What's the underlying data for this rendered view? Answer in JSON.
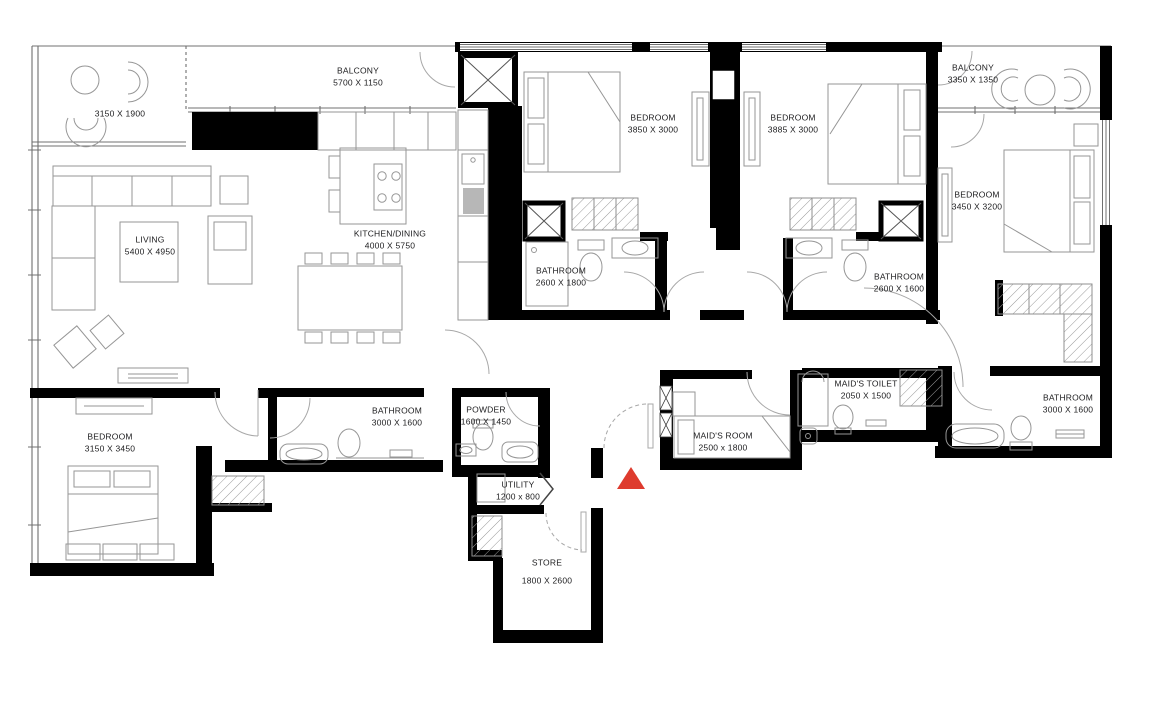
{
  "plan": {
    "background": "#ffffff",
    "wall_color": "#000000",
    "furniture_line_color": "#969696",
    "label_color": "#1c1c1e",
    "marker_color": "#de3b2e"
  },
  "marker": {
    "name": "entrance-marker",
    "shape": "red-triangle"
  },
  "rooms": [
    {
      "id": "balcony-left",
      "label": "",
      "dims": "3150 X 1900"
    },
    {
      "id": "balcony-top",
      "label": "BALCONY",
      "dims": "5700 X 1150"
    },
    {
      "id": "living",
      "label": "LIVING",
      "dims": "5400 X 4950"
    },
    {
      "id": "kitchen-dining",
      "label": "KITCHEN/DINING",
      "dims": "4000 X 5750"
    },
    {
      "id": "bedroom-1",
      "label": "BEDROOM",
      "dims": "3850 X 3000"
    },
    {
      "id": "bedroom-2",
      "label": "BEDROOM",
      "dims": "3885 X 3000"
    },
    {
      "id": "balcony-right",
      "label": "BALCONY",
      "dims": "3350 X 1350"
    },
    {
      "id": "bedroom-3",
      "label": "BEDROOM",
      "dims": "3450 X 3200"
    },
    {
      "id": "bathroom-1",
      "label": "BATHROOM",
      "dims": "2600 X 1800"
    },
    {
      "id": "bathroom-2",
      "label": "BATHROOM",
      "dims": "2600 X 1600"
    },
    {
      "id": "bathroom-3",
      "label": "BATHROOM",
      "dims": "3000 X 1600"
    },
    {
      "id": "bedroom-4",
      "label": "BEDROOM",
      "dims": "3150 X 3450"
    },
    {
      "id": "bathroom-4",
      "label": "BATHROOM",
      "dims": "3000 X 1600"
    },
    {
      "id": "powder",
      "label": "POWDER",
      "dims": "1600 X 1450"
    },
    {
      "id": "utility",
      "label": "UTILITY",
      "dims": "1200 x 800"
    },
    {
      "id": "store",
      "label": "STORE",
      "dims": "1800 X 2600"
    },
    {
      "id": "maids-room",
      "label": "MAID'S ROOM",
      "dims": "2500 x 1800"
    },
    {
      "id": "maids-toilet",
      "label": "MAID'S TOILET",
      "dims": "2050 X 1500"
    }
  ]
}
